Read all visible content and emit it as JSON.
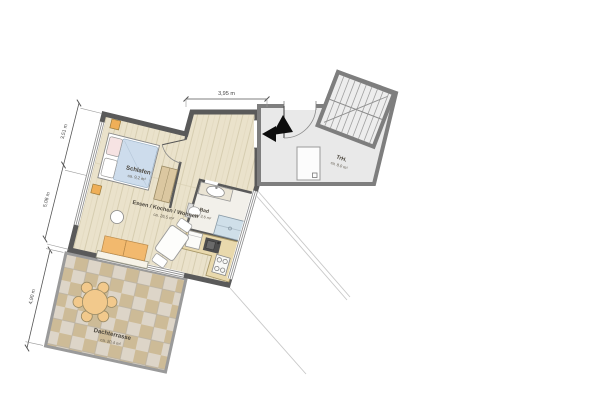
{
  "plan": {
    "rooms": {
      "bedroom": {
        "name": "Schlafen",
        "area": "ca. 9,2 m²"
      },
      "living": {
        "name": "Essen / Kochen / Wohnen",
        "area": "ca. 26,5 m²"
      },
      "bath": {
        "name": "Bad",
        "area": "ca. 3,6 m²"
      },
      "stairwell": {
        "name": "TrH.",
        "area": "ca. 8,0 m²"
      },
      "terrace": {
        "name": "Dachterrasse",
        "area": "ca. 20,4 m²"
      }
    },
    "dimensions": {
      "top": "3,95 m",
      "left_upper": "3,51 m",
      "left_lower": "5,08 m",
      "terrace_side": "4,90 m"
    },
    "colors": {
      "wall": "#5a5a5a",
      "stair_wall": "#7e7e7e",
      "wood_floor": "#eae2cb",
      "tile_a": "#ddd5c8",
      "tile_b": "#cdbb97",
      "stair_floor": "#e9e9e9",
      "furniture_orange": "#f2b96e",
      "duvet_blue": "#cddcec",
      "terrace_furniture": "#f2c98c",
      "shower_blue": "#cfdfe9"
    }
  }
}
